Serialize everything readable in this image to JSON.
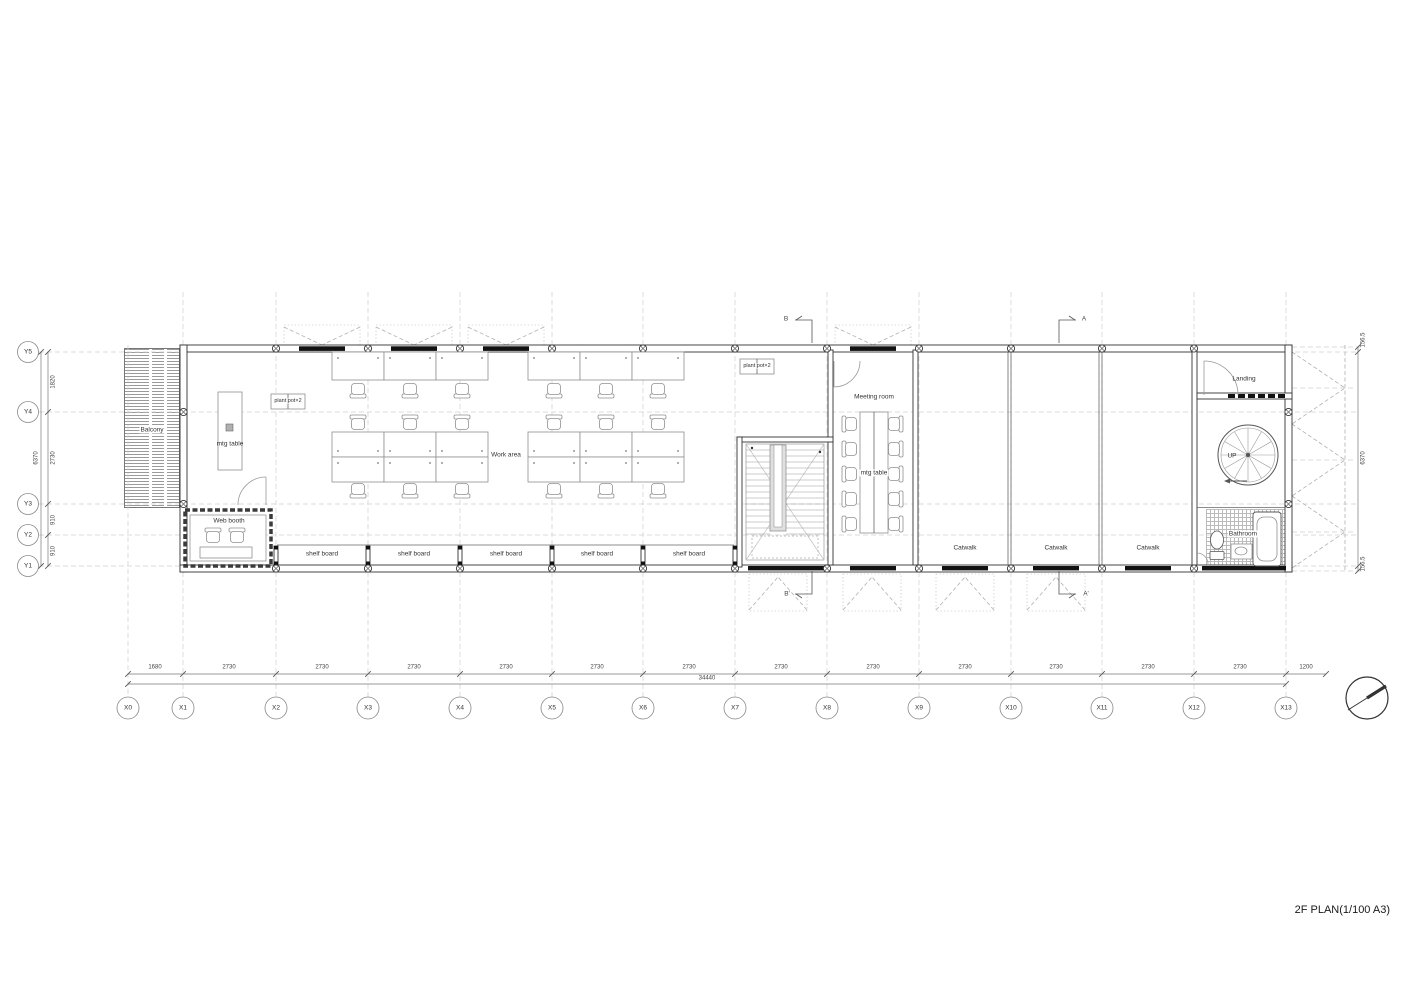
{
  "title": "2F PLAN(1/100 A3)",
  "rooms": {
    "balcony": "Balcony",
    "web_booth": "Web booth",
    "work_area": "Work area",
    "meeting_room": "Meeting room",
    "landing": "Landing",
    "bathroom": "Bathroom",
    "up": "UP"
  },
  "furniture": {
    "mtg_table": "mtg table",
    "plant_pot": "plant pot×2",
    "shelf_board": "shelf board",
    "catwalk": "Catwalk"
  },
  "sections": {
    "a": "A",
    "a_prime": "A'",
    "b": "B",
    "b_prime": "B'"
  },
  "grid": {
    "x_labels": [
      "X0",
      "X1",
      "X2",
      "X3",
      "X4",
      "X5",
      "X6",
      "X7",
      "X8",
      "X9",
      "X10",
      "X11",
      "X12",
      "X13"
    ],
    "y_labels": [
      "Y5",
      "Y4",
      "Y3",
      "Y2",
      "Y1"
    ]
  },
  "dimensions": {
    "bottom": [
      "1680",
      "2730",
      "2730",
      "2730",
      "2730",
      "2730",
      "2730",
      "2730",
      "2730",
      "2730",
      "2730",
      "2730",
      "2730",
      "1200"
    ],
    "bottom_total": "34440",
    "left_total": "6370",
    "left_segments": [
      "1820",
      "2730",
      "910",
      "910"
    ],
    "right": [
      "156.5",
      "6370",
      "156.5"
    ]
  }
}
